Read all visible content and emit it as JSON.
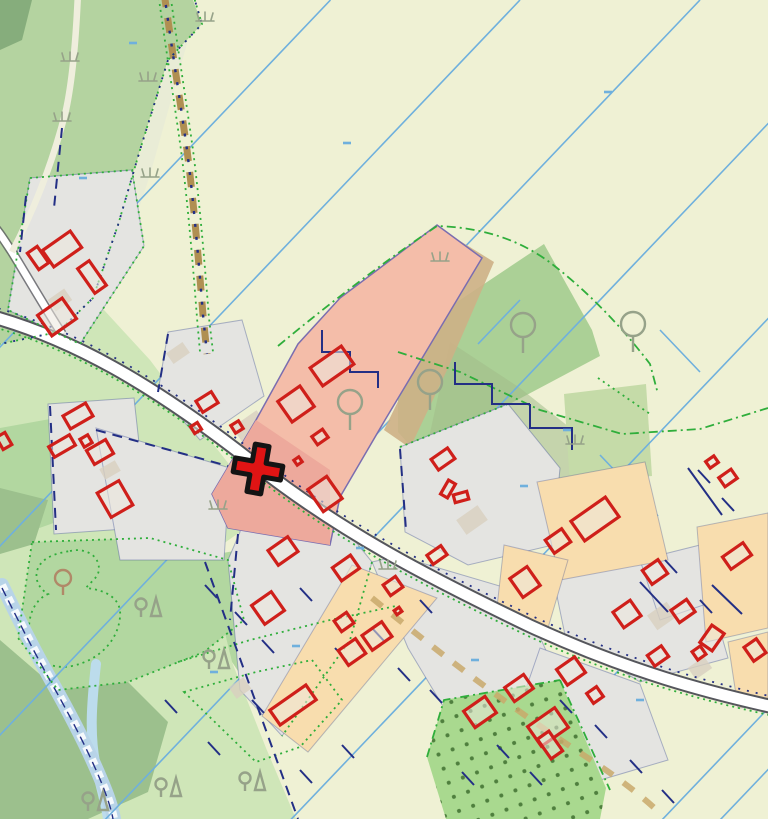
{
  "app": {
    "name": "map-viewer",
    "description": "Cadastral topographic map view with highlighted parcel and cross placemark",
    "visible_text": []
  },
  "colors": {
    "field": "#eff1d4",
    "forest": "#b4d3a0",
    "forest_dark": "#86ad7c",
    "clearing": "#e9ecd6",
    "meadow": "#cfe6b8",
    "meadow_mid": "#b2d7a0",
    "meadow_dark": "#9cc08d",
    "green_parcel": "#abd096",
    "sage": "#c5dba8",
    "sage_dark": "#a2bb8b",
    "orchard": "#a9d98f",
    "orchard_dot": "#4f7f3e",
    "water": "#bcdcec",
    "stream": "#b8d4e8",
    "gray_parcel": "#e4e4e1",
    "beige": "#d8d0bf",
    "orange_parcel": "#f8ddae",
    "pink_parcel": "#f4bda9",
    "pink_deep": "#eda99c",
    "pink_outline": "#7a6db0",
    "tan_band": "#cdb086",
    "road_casing": "#55565c",
    "road_fill": "#ffffff",
    "road_pale": "#efeedd",
    "track_brown": "#b08f52",
    "track_tan": "#c9a96b",
    "boundary_green": "#2fae3b",
    "drainage_blue": "#6fb0dd",
    "navy": "#232f85",
    "building_red": "#cf1f1a",
    "building_fill": "rgba(236,231,222,0.55)",
    "tree_gray": "#96a289",
    "tree_brown": "#b08968",
    "marker_red": "#e01414",
    "marker_outline": "#141414"
  },
  "marker": {
    "name": "placemark-cross",
    "x": 258,
    "y": 469,
    "transform": "translate(258,469) rotate(10)"
  },
  "layers": {
    "drainage": {
      "slope": 1.05,
      "intercepts": [
        347,
        546,
        735,
        930,
        1125,
        1320,
        1515,
        1576
      ],
      "short_segments": [
        [
          437,
          296,
          350,
          387
        ],
        [
          390,
          420,
          332,
          481
        ],
        [
          470,
          420,
          428,
          464
        ],
        [
          555,
          585,
          618,
          651
        ],
        [
          600,
          455,
          658,
          516
        ],
        [
          218,
          470,
          172,
          518
        ],
        [
          300,
          560,
          257,
          605
        ],
        [
          480,
          610,
          442,
          650
        ],
        [
          660,
          330,
          700,
          372
        ],
        [
          520,
          300,
          478,
          344
        ]
      ]
    },
    "buildings": [
      [
        62,
        249,
        34,
        20,
        -35
      ],
      [
        38,
        258,
        12,
        20,
        -35
      ],
      [
        92,
        277,
        14,
        30,
        -35
      ],
      [
        57,
        317,
        30,
        25,
        -35
      ],
      [
        4,
        441,
        10,
        14,
        -30
      ],
      [
        78,
        416,
        26,
        15,
        -30
      ],
      [
        62,
        446,
        24,
        12,
        -30
      ],
      [
        86,
        441,
        9,
        9,
        -30
      ],
      [
        100,
        452,
        22,
        16,
        -30
      ],
      [
        115,
        499,
        25,
        28,
        -30
      ],
      [
        207,
        402,
        18,
        13,
        -32
      ],
      [
        237,
        427,
        9,
        9,
        -32
      ],
      [
        196,
        428,
        8,
        8,
        -32
      ],
      [
        332,
        366,
        38,
        22,
        -35
      ],
      [
        296,
        404,
        27,
        25,
        -35
      ],
      [
        320,
        437,
        13,
        10,
        -35
      ],
      [
        298,
        461,
        6,
        6,
        -35
      ],
      [
        325,
        494,
        23,
        27,
        -35
      ],
      [
        283,
        551,
        24,
        18,
        -35
      ],
      [
        346,
        568,
        22,
        16,
        -35
      ],
      [
        393,
        586,
        15,
        13,
        -35
      ],
      [
        268,
        608,
        24,
        23,
        -35
      ],
      [
        344,
        622,
        15,
        13,
        -35
      ],
      [
        377,
        636,
        24,
        18,
        -35
      ],
      [
        352,
        652,
        21,
        18,
        -35
      ],
      [
        293,
        705,
        44,
        18,
        -35
      ],
      [
        398,
        611,
        6,
        5,
        -35
      ],
      [
        443,
        459,
        20,
        13,
        -35
      ],
      [
        448,
        489,
        16,
        8,
        -60
      ],
      [
        461,
        497,
        14,
        8,
        -15
      ],
      [
        437,
        555,
        17,
        11,
        -35
      ],
      [
        525,
        582,
        21,
        23,
        -35
      ],
      [
        558,
        541,
        20,
        16,
        -35
      ],
      [
        595,
        519,
        42,
        24,
        -35
      ],
      [
        480,
        712,
        26,
        20,
        -35
      ],
      [
        519,
        688,
        23,
        17,
        -35
      ],
      [
        548,
        727,
        33,
        24,
        -35
      ],
      [
        550,
        745,
        14,
        24,
        -35
      ],
      [
        571,
        671,
        22,
        19,
        -35
      ],
      [
        595,
        695,
        12,
        12,
        -35
      ],
      [
        627,
        614,
        21,
        19,
        -35
      ],
      [
        655,
        572,
        19,
        17,
        -35
      ],
      [
        683,
        611,
        19,
        15,
        -35
      ],
      [
        658,
        656,
        17,
        13,
        -35
      ],
      [
        712,
        638,
        21,
        15,
        -55
      ],
      [
        699,
        653,
        10,
        10,
        -35
      ],
      [
        737,
        556,
        25,
        15,
        -35
      ],
      [
        755,
        650,
        15,
        17,
        -35
      ],
      [
        728,
        478,
        15,
        11,
        -35
      ],
      [
        712,
        462,
        10,
        8,
        -35
      ]
    ],
    "beige_patches": [
      [
        250,
        427,
        30,
        20,
        -35
      ],
      [
        472,
        520,
        26,
        18,
        -35
      ],
      [
        600,
        502,
        34,
        22,
        -35
      ],
      [
        662,
        616,
        24,
        18,
        -35
      ],
      [
        536,
        700,
        22,
        16,
        -35
      ],
      [
        178,
        353,
        20,
        13,
        -35
      ],
      [
        240,
        688,
        18,
        14,
        -35
      ],
      [
        700,
        668,
        20,
        14,
        -35
      ],
      [
        744,
        620,
        16,
        12,
        -35
      ],
      [
        304,
        690,
        24,
        16,
        -35
      ],
      [
        60,
        300,
        20,
        14,
        -35
      ],
      [
        110,
        470,
        18,
        12,
        -30
      ]
    ],
    "symbols": {
      "trees": [
        [
          350,
          410
        ],
        [
          430,
          390
        ],
        [
          523,
          333
        ],
        [
          633,
          332
        ]
      ],
      "pond_tree": [
        [
          63,
          583
        ]
      ],
      "conifer_pairs": [
        [
          148,
          608
        ],
        [
          216,
          660
        ],
        [
          168,
          788
        ],
        [
          95,
          802
        ],
        [
          252,
          782
        ]
      ],
      "grass": [
        [
          70,
          60
        ],
        [
          148,
          80
        ],
        [
          150,
          176
        ],
        [
          440,
          260
        ],
        [
          575,
          443
        ],
        [
          388,
          568
        ],
        [
          218,
          508
        ],
        [
          62,
          120
        ],
        [
          205,
          20
        ]
      ],
      "blue_ticks": [
        [
          347,
          143
        ],
        [
          608,
          92
        ],
        [
          83,
          178
        ],
        [
          524,
          486
        ],
        [
          296,
          646
        ],
        [
          360,
          548
        ],
        [
          214,
          672
        ],
        [
          475,
          660
        ],
        [
          567,
          430
        ],
        [
          133,
          43
        ],
        [
          640,
          700
        ]
      ],
      "navy_ticks": [
        [
          205,
          585
        ],
        [
          235,
          612
        ],
        [
          300,
          588
        ],
        [
          262,
          640
        ],
        [
          335,
          648
        ],
        [
          372,
          628
        ],
        [
          398,
          668
        ],
        [
          430,
          690
        ],
        [
          300,
          770
        ],
        [
          342,
          745
        ],
        [
          252,
          700
        ],
        [
          462,
          772
        ],
        [
          497,
          745
        ],
        [
          530,
          772
        ],
        [
          208,
          742
        ],
        [
          165,
          700
        ],
        [
          420,
          600
        ],
        [
          560,
          700
        ],
        [
          595,
          725
        ],
        [
          630,
          760
        ],
        [
          662,
          790
        ],
        [
          700,
          600
        ],
        [
          665,
          560
        ],
        [
          698,
          470
        ],
        [
          722,
          498
        ]
      ]
    }
  }
}
